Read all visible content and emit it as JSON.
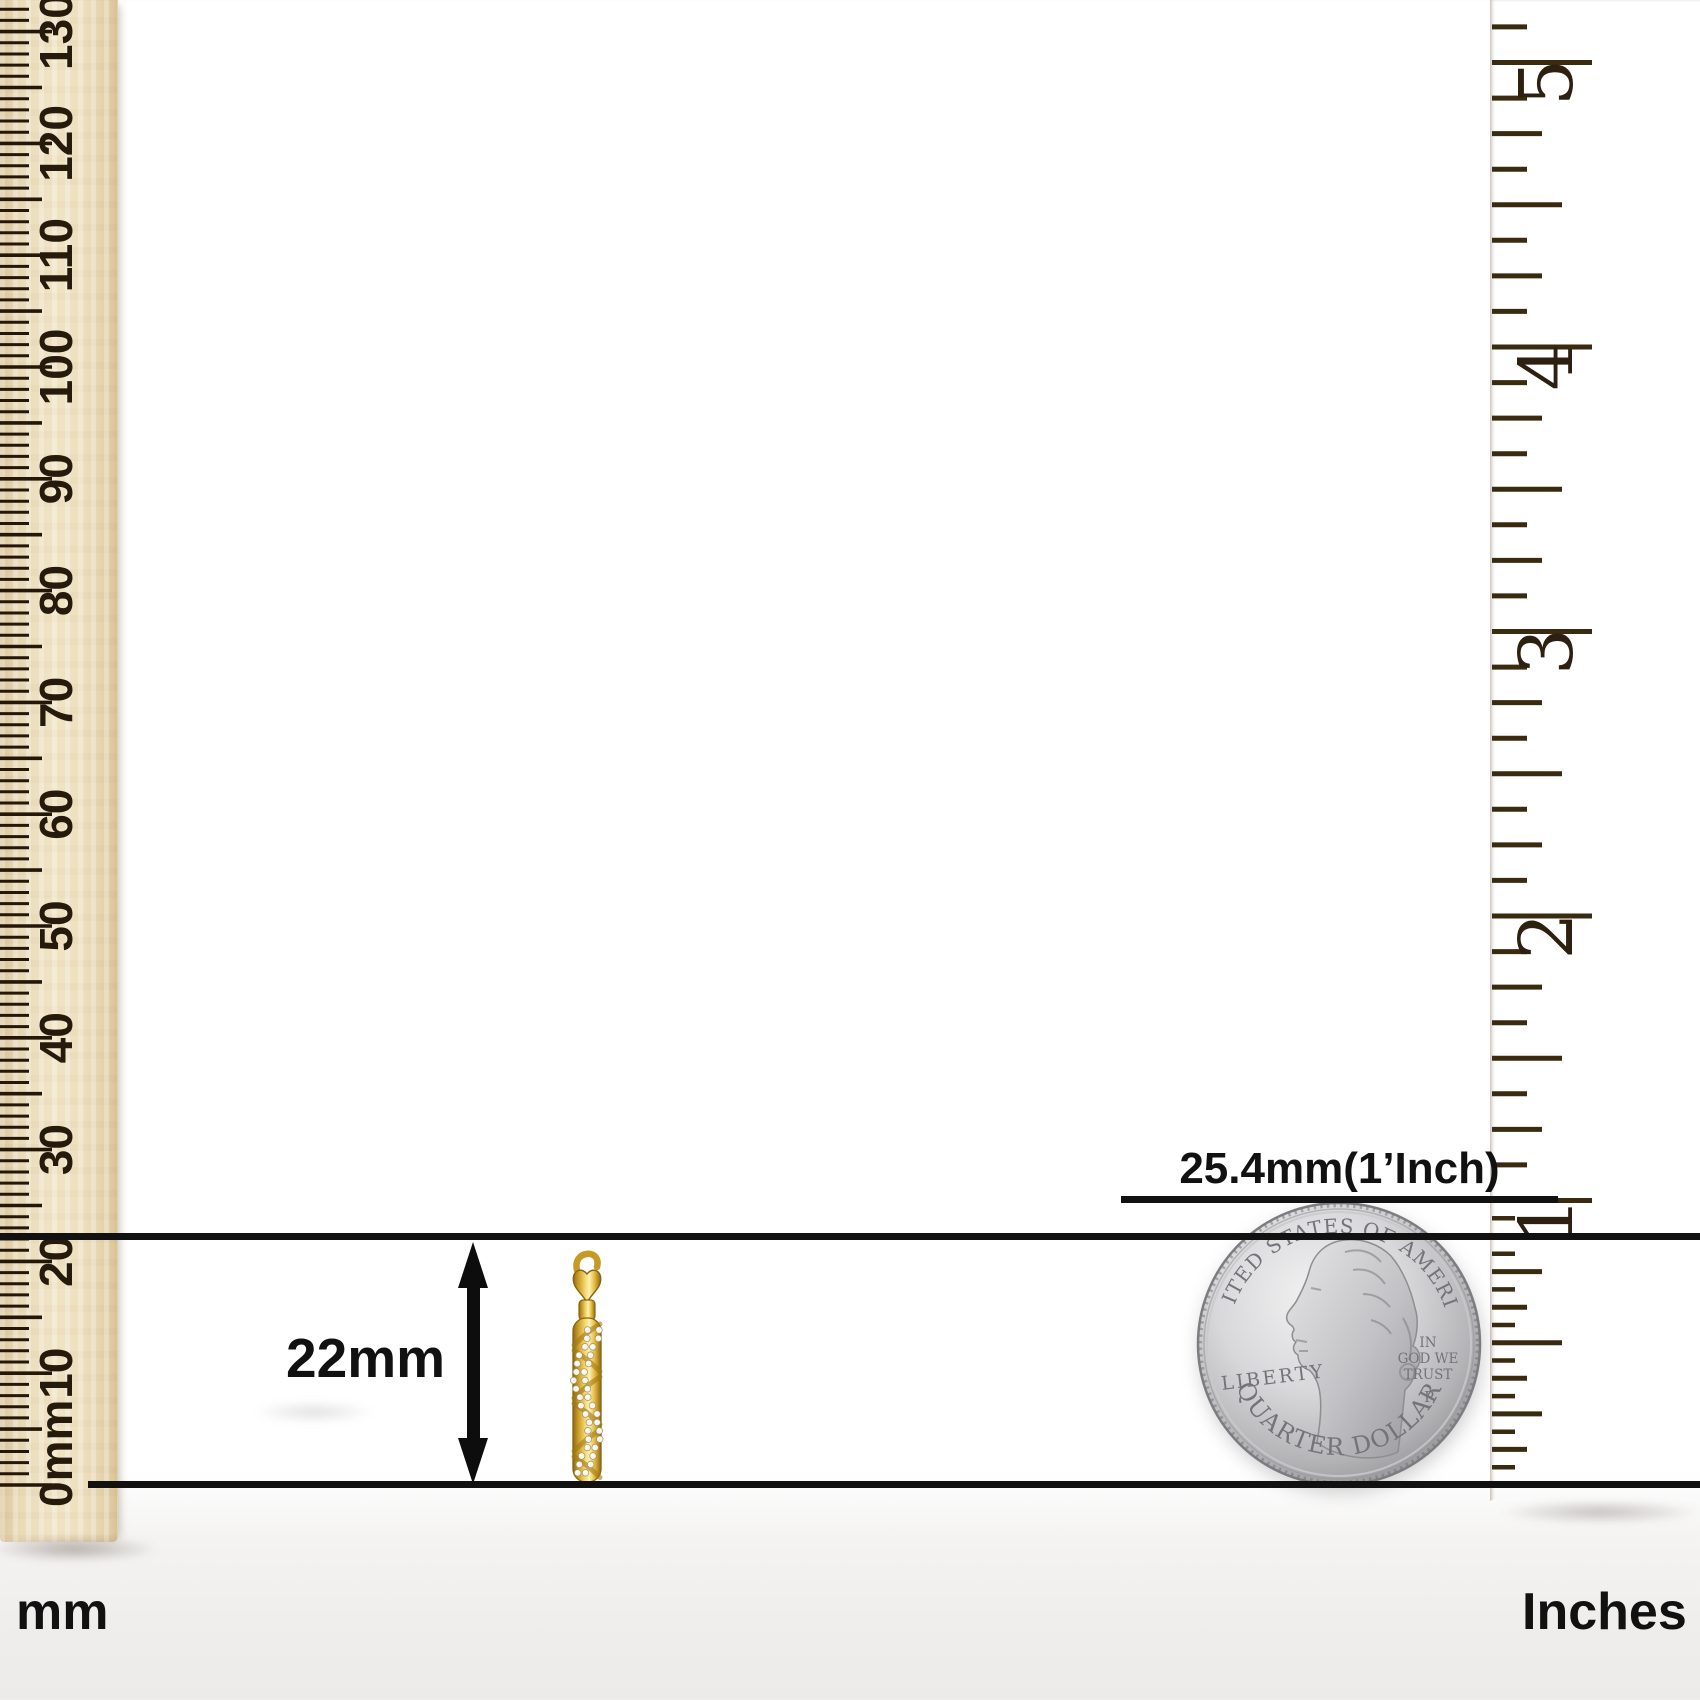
{
  "labels": {
    "dimension": "22mm",
    "coin_reference": "25.4mm(1’Inch)",
    "left_unit": "mm",
    "right_unit": "Inches"
  },
  "mm_ruler": {
    "numbers": [
      "0mm",
      "10",
      "20",
      "30",
      "40",
      "50",
      "60",
      "70",
      "80",
      "90",
      "100",
      "110",
      "120",
      "130"
    ],
    "step_mm": 10,
    "px_per_mm": 11.18,
    "zero_y": 1485,
    "tick_color": "#241708",
    "number_color": "#261a0c"
  },
  "inch_ruler": {
    "numbers": [
      "1",
      "2",
      "3",
      "4",
      "5"
    ],
    "px_per_inch": 284.5,
    "zero_y": 1485,
    "tick_color": "#3a2a10",
    "number_color": "#2e2010"
  },
  "coin": {
    "top_text": "UNITED STATES OF AMERICA",
    "left_text": "LIBERTY",
    "motto": [
      "IN",
      "GOD WE",
      "TRUST"
    ],
    "mint_mark": "P",
    "bottom_text": "QUARTER DOLLAR"
  },
  "colors": {
    "measurement_line": "#111111",
    "label_text": "#111111",
    "left_wood": "#ebdab6",
    "right_wood": "#eccb97",
    "wood_stripe": "#c9924d",
    "gold": "#e3b93f",
    "diamond": "#f6f4ef",
    "coin_silver": "#c7c7c9"
  }
}
